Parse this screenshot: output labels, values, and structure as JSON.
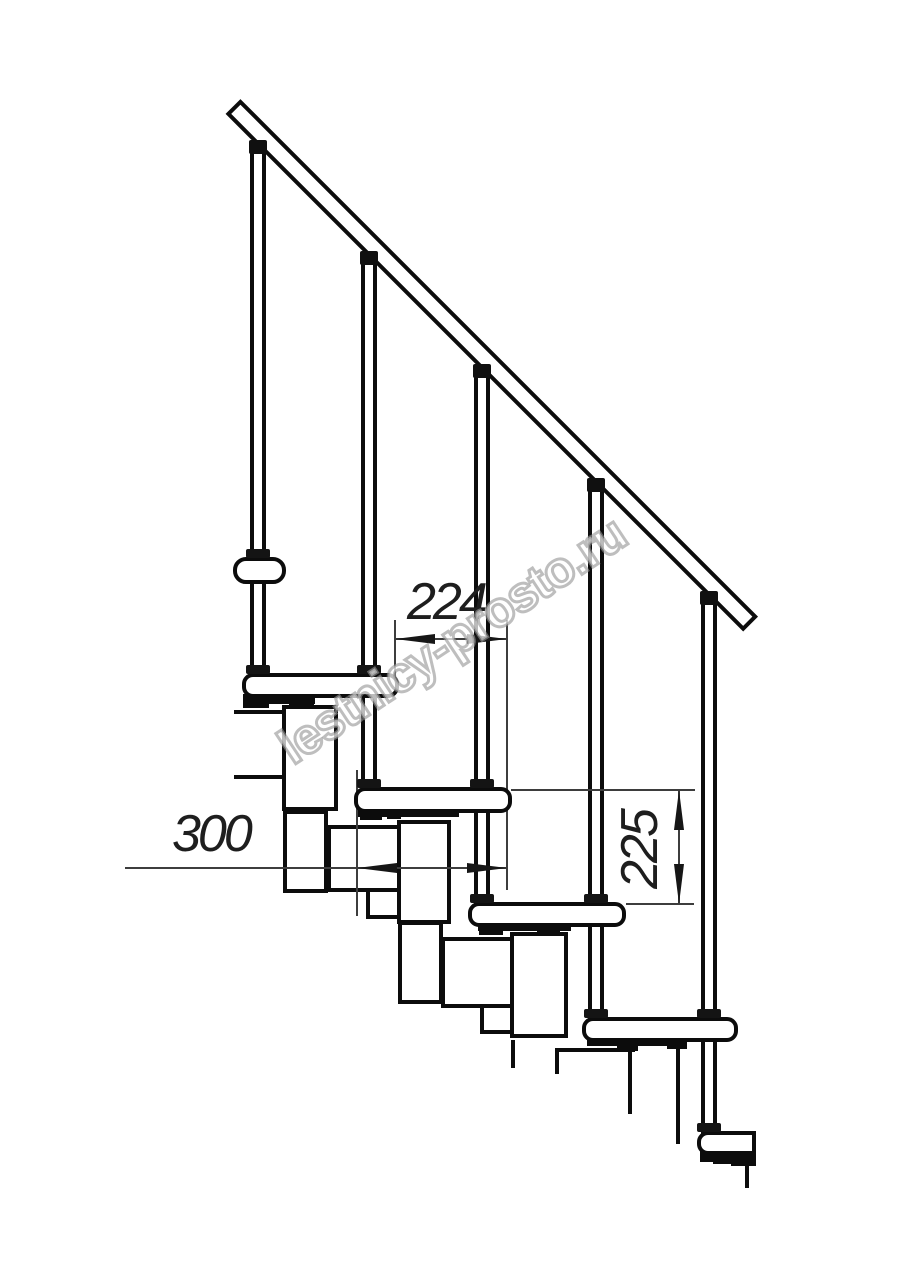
{
  "drawing": {
    "watermark": "lestnicy-prosto.ru",
    "dimensions": {
      "run_224": "224",
      "depth_300": "300",
      "rise_225": "225"
    }
  }
}
